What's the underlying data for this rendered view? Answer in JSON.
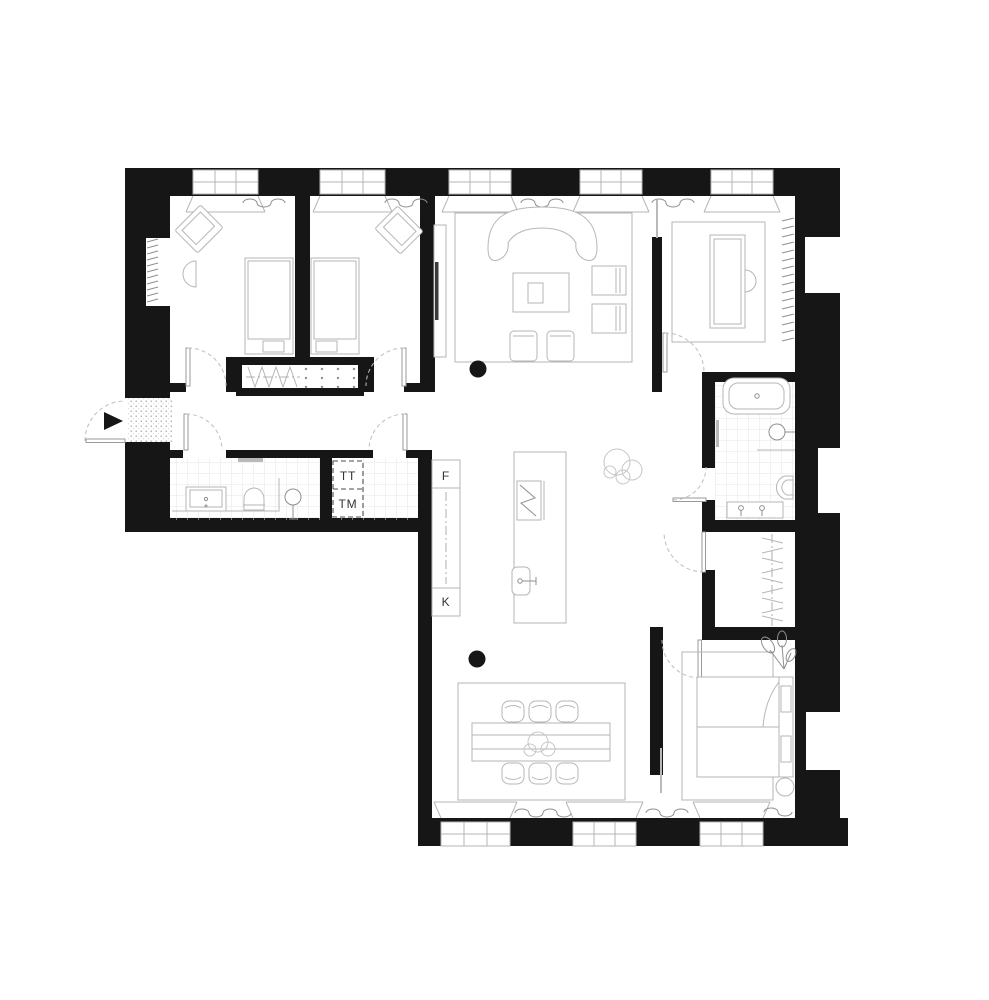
{
  "plan": {
    "type": "apartment-floor-plan",
    "labels": {
      "kitchen_tall_unit_top": "F",
      "kitchen_tall_unit_bottom": "K",
      "laundry_stack_top": "TT",
      "laundry_stack_bottom": "TM"
    }
  },
  "colors": {
    "wall": "#161616",
    "line-light": "#b6b6b6",
    "line-mid": "#8f8f8f",
    "tile": "#e6e6e6",
    "label": "#333333",
    "bg": "#ffffff"
  }
}
